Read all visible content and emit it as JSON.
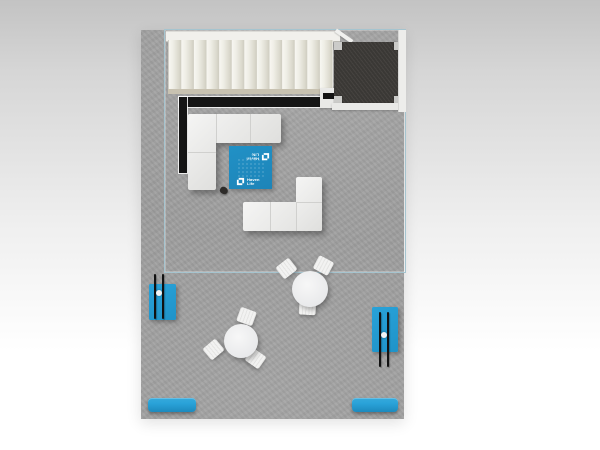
{
  "brand": {
    "name": "Haven Life",
    "line1": "Haven",
    "line2": "Life"
  },
  "icons": {
    "havenlife_logo_icon": "interlocking-brackets-square"
  },
  "colors": {
    "floor": "#9e9e9e",
    "glass_line": "#a5c4cf",
    "railing_black": "#151515",
    "platform_charcoal": "#3e3b38",
    "sofa_white": "#ebebe9",
    "rug_blue": "#2191c6",
    "bench_blue": "#29a2d8",
    "table_white": "#e6e7e9"
  }
}
